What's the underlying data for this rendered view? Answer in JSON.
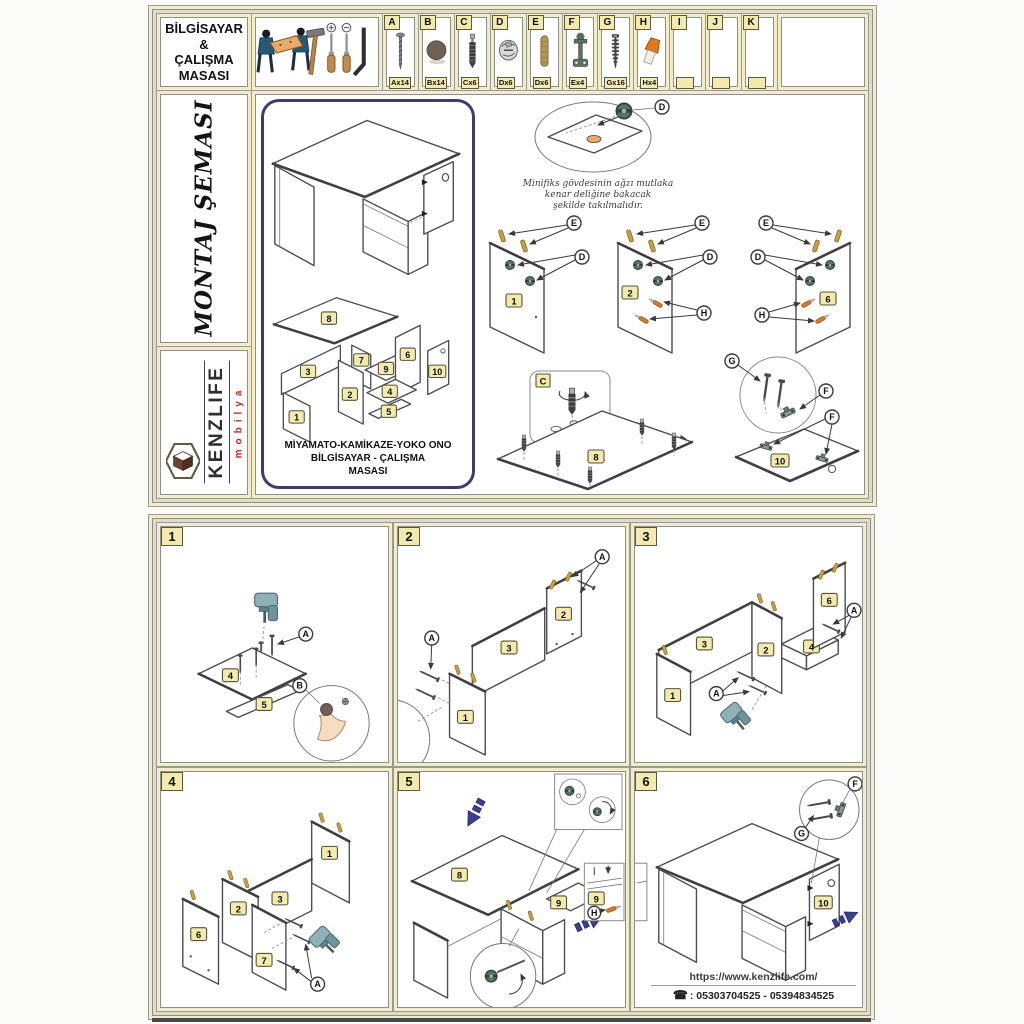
{
  "header": {
    "title_lines": [
      "BİLGİSAYAR",
      "&",
      "ÇALIŞMA",
      "MASASI"
    ]
  },
  "hardware": [
    {
      "letter": "A",
      "qty": "Ax14",
      "icon": "screw-icon"
    },
    {
      "letter": "B",
      "qty": "Bx14",
      "icon": "cover-cap-icon"
    },
    {
      "letter": "C",
      "qty": "Cx6",
      "icon": "minifix-bolt-icon"
    },
    {
      "letter": "D",
      "qty": "Dx6",
      "icon": "cam-lock-icon"
    },
    {
      "letter": "E",
      "qty": "Dx6",
      "icon": "wood-dowel-icon"
    },
    {
      "letter": "F",
      "qty": "Ex4",
      "icon": "mounting-bracket-icon"
    },
    {
      "letter": "G",
      "qty": "Gx16",
      "icon": "chipboard-screw-icon"
    },
    {
      "letter": "H",
      "qty": "Hx4",
      "icon": "plastic-cap-icon"
    },
    {
      "letter": "I",
      "qty": "",
      "icon": ""
    },
    {
      "letter": "J",
      "qty": "",
      "icon": ""
    },
    {
      "letter": "K",
      "qty": "",
      "icon": ""
    }
  ],
  "sidebar": {
    "schema_title": "MONTAJ ŞEMASI",
    "brand": "KENZLIFE",
    "brand_sub": "mobilya"
  },
  "product": {
    "name_line1": "MİYAMATO-KAMİKAZE-YOKO ONO",
    "name_line2": "BİLGİSAYAR - ÇALIŞMA",
    "name_line3": "MASASI"
  },
  "note": {
    "line1": "Minifiks gövdesinin ağzı mutlaka",
    "line2": "kenar deliğine bakacak",
    "line3": "şekilde takılmalıdır."
  },
  "labels": {
    "A": "A",
    "B": "B",
    "C": "C",
    "D": "D",
    "E": "E",
    "F": "F",
    "G": "G",
    "H": "H",
    "p1": "1",
    "p2": "2",
    "p3": "3",
    "p4": "4",
    "p5": "5",
    "p6": "6",
    "p7": "7",
    "p8": "8",
    "p9": "9",
    "p10": "10"
  },
  "steps": {
    "s1": "1",
    "s2": "2",
    "s3": "3",
    "s4": "4",
    "s5": "5",
    "s6": "6"
  },
  "footer": {
    "website": "https://www.kenzlife.com/",
    "phone_icon": "☎",
    "phones": ": 05303704525 - 05394834525"
  },
  "colors": {
    "tag_yellow": "#f3eaae",
    "frame_cream": "#f2edc9",
    "arrow_blue": "#3d3d92",
    "brand_red": "#c22727",
    "dowel_tan": "#c9a33b",
    "cam_green": "#5a7263",
    "cap_orange": "#d97a2b",
    "panel_border_navy": "#3d3d6b"
  }
}
